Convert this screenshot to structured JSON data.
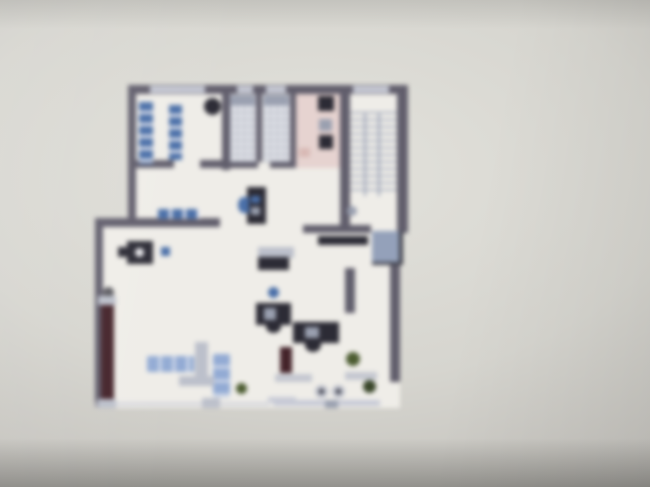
{
  "scene": {
    "kind": "photograph of a screen displaying an architectural floor plan",
    "visible_text": ""
  },
  "colors": {
    "bg_center": "#e3e2dc",
    "bg_corner": "#adaba6",
    "paper": "#efede8",
    "wall": "#615e6c",
    "wall_light": "#c7cad6",
    "blue": "#4a6fa8",
    "blue_light": "#93abd4",
    "pink": "#e6d3d0",
    "pink_dark": "#d8b9b5",
    "dark": "#2c2b35",
    "gray_furn": "#bcc0cb",
    "gray_mid": "#9aa0b0",
    "maroon": "#44232a",
    "green": "#4c5c31",
    "green_dark": "#39462a",
    "mat": "#94a1ba",
    "tile_line": "#aab0bf",
    "tile_bg": "#e2e3e8",
    "tread": "#9aa2b6"
  }
}
